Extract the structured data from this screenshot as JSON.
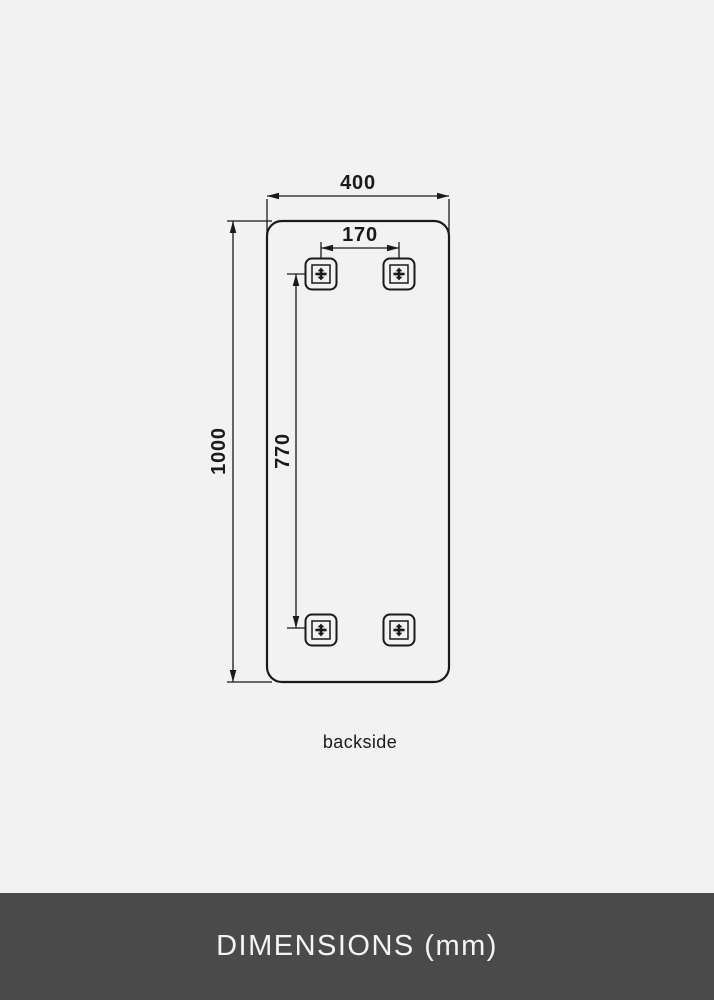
{
  "diagram": {
    "view_label": "backside",
    "width_mm": "400",
    "height_mm": "1000",
    "bracket_spacing_horizontal_mm": "170",
    "bracket_spacing_vertical_mm": "770"
  },
  "footer": {
    "title": "DIMENSIONS (mm)"
  },
  "colors": {
    "background": "#f2f2f2",
    "line": "#1a1a1a",
    "footer_background": "#4a4a4a",
    "footer_text": "#f4f4f4"
  }
}
